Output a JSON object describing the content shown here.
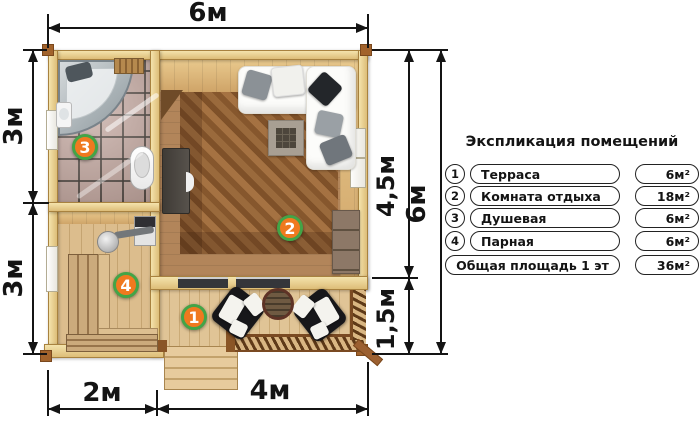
{
  "legend": {
    "title": "Экспликация помещений",
    "rows": [
      {
        "num": "1",
        "name": "Терраса",
        "area": "6м²"
      },
      {
        "num": "2",
        "name": "Комната отдыха",
        "area": "18м²"
      },
      {
        "num": "3",
        "name": "Душевая",
        "area": "6м²"
      },
      {
        "num": "4",
        "name": "Парная",
        "area": "6м²"
      },
      {
        "num": "",
        "name": "Общая площадь 1 эт",
        "area": "36м²"
      }
    ]
  },
  "dimensions": {
    "top_width": "6м",
    "left_upper": "3м",
    "left_lower": "3м",
    "right_upper": "4,5м",
    "right_lower": "1,5м",
    "right_total": "6м",
    "bottom_left": "2м",
    "bottom_right": "4м"
  },
  "plan": {
    "badges": [
      "1",
      "2",
      "3",
      "4"
    ],
    "colors": {
      "badge-fill": "#f0791f",
      "badge-ring": "#43a447",
      "dim-color": "#141414",
      "wall-light": "#f4e3ac",
      "wall-dark": "#ddbd78",
      "wall-edge": "#a8823f"
    }
  }
}
